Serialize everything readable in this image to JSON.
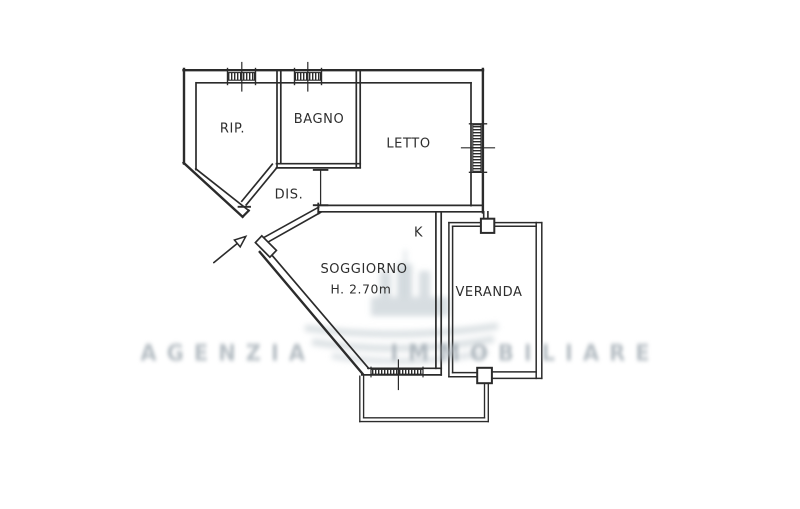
{
  "plan": {
    "rooms": [
      {
        "name": "ripostiglio",
        "label": "RIP."
      },
      {
        "name": "bagno",
        "label": "BAGNO"
      },
      {
        "name": "letto",
        "label": "LETTO"
      },
      {
        "name": "disimpegno",
        "label": "DIS."
      },
      {
        "name": "angolo-cottura",
        "label": "K"
      },
      {
        "name": "soggiorno",
        "label": "SOGGIORNO",
        "ceiling_height": "H. 2.70m"
      },
      {
        "name": "veranda",
        "label": "VERANDA"
      }
    ],
    "watermark": {
      "text": "AGENZIA IMMOBILIARE"
    },
    "colors": {
      "wall": "#2b2b2b",
      "label": "#2e2e2e",
      "watermark_gray": "#ccd4d9",
      "background": "#ffffff"
    }
  }
}
